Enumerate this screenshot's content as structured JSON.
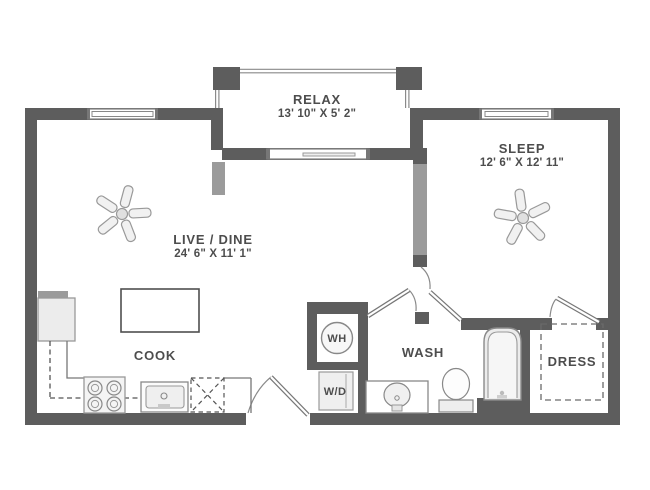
{
  "floorplan": {
    "rooms": {
      "relax": {
        "label": "RELAX",
        "dims": "13' 10\" X 5' 2\""
      },
      "sleep": {
        "label": "SLEEP",
        "dims": "12' 6\" X 12' 11\""
      },
      "live_dine": {
        "label": "LIVE / DINE",
        "dims": "24' 6\" X 11' 1\""
      },
      "cook": {
        "label": "COOK"
      },
      "wash": {
        "label": "WASH"
      },
      "dress": {
        "label": "DRESS"
      }
    },
    "fixtures": {
      "water_heater": {
        "label": "WH"
      },
      "washer_dryer": {
        "label": "W/D"
      }
    },
    "colors": {
      "wall_dark": "#5d5d5d",
      "wall_light": "#9b9b9b",
      "line": "#8a8a8a",
      "text": "#4d4d4d"
    }
  }
}
